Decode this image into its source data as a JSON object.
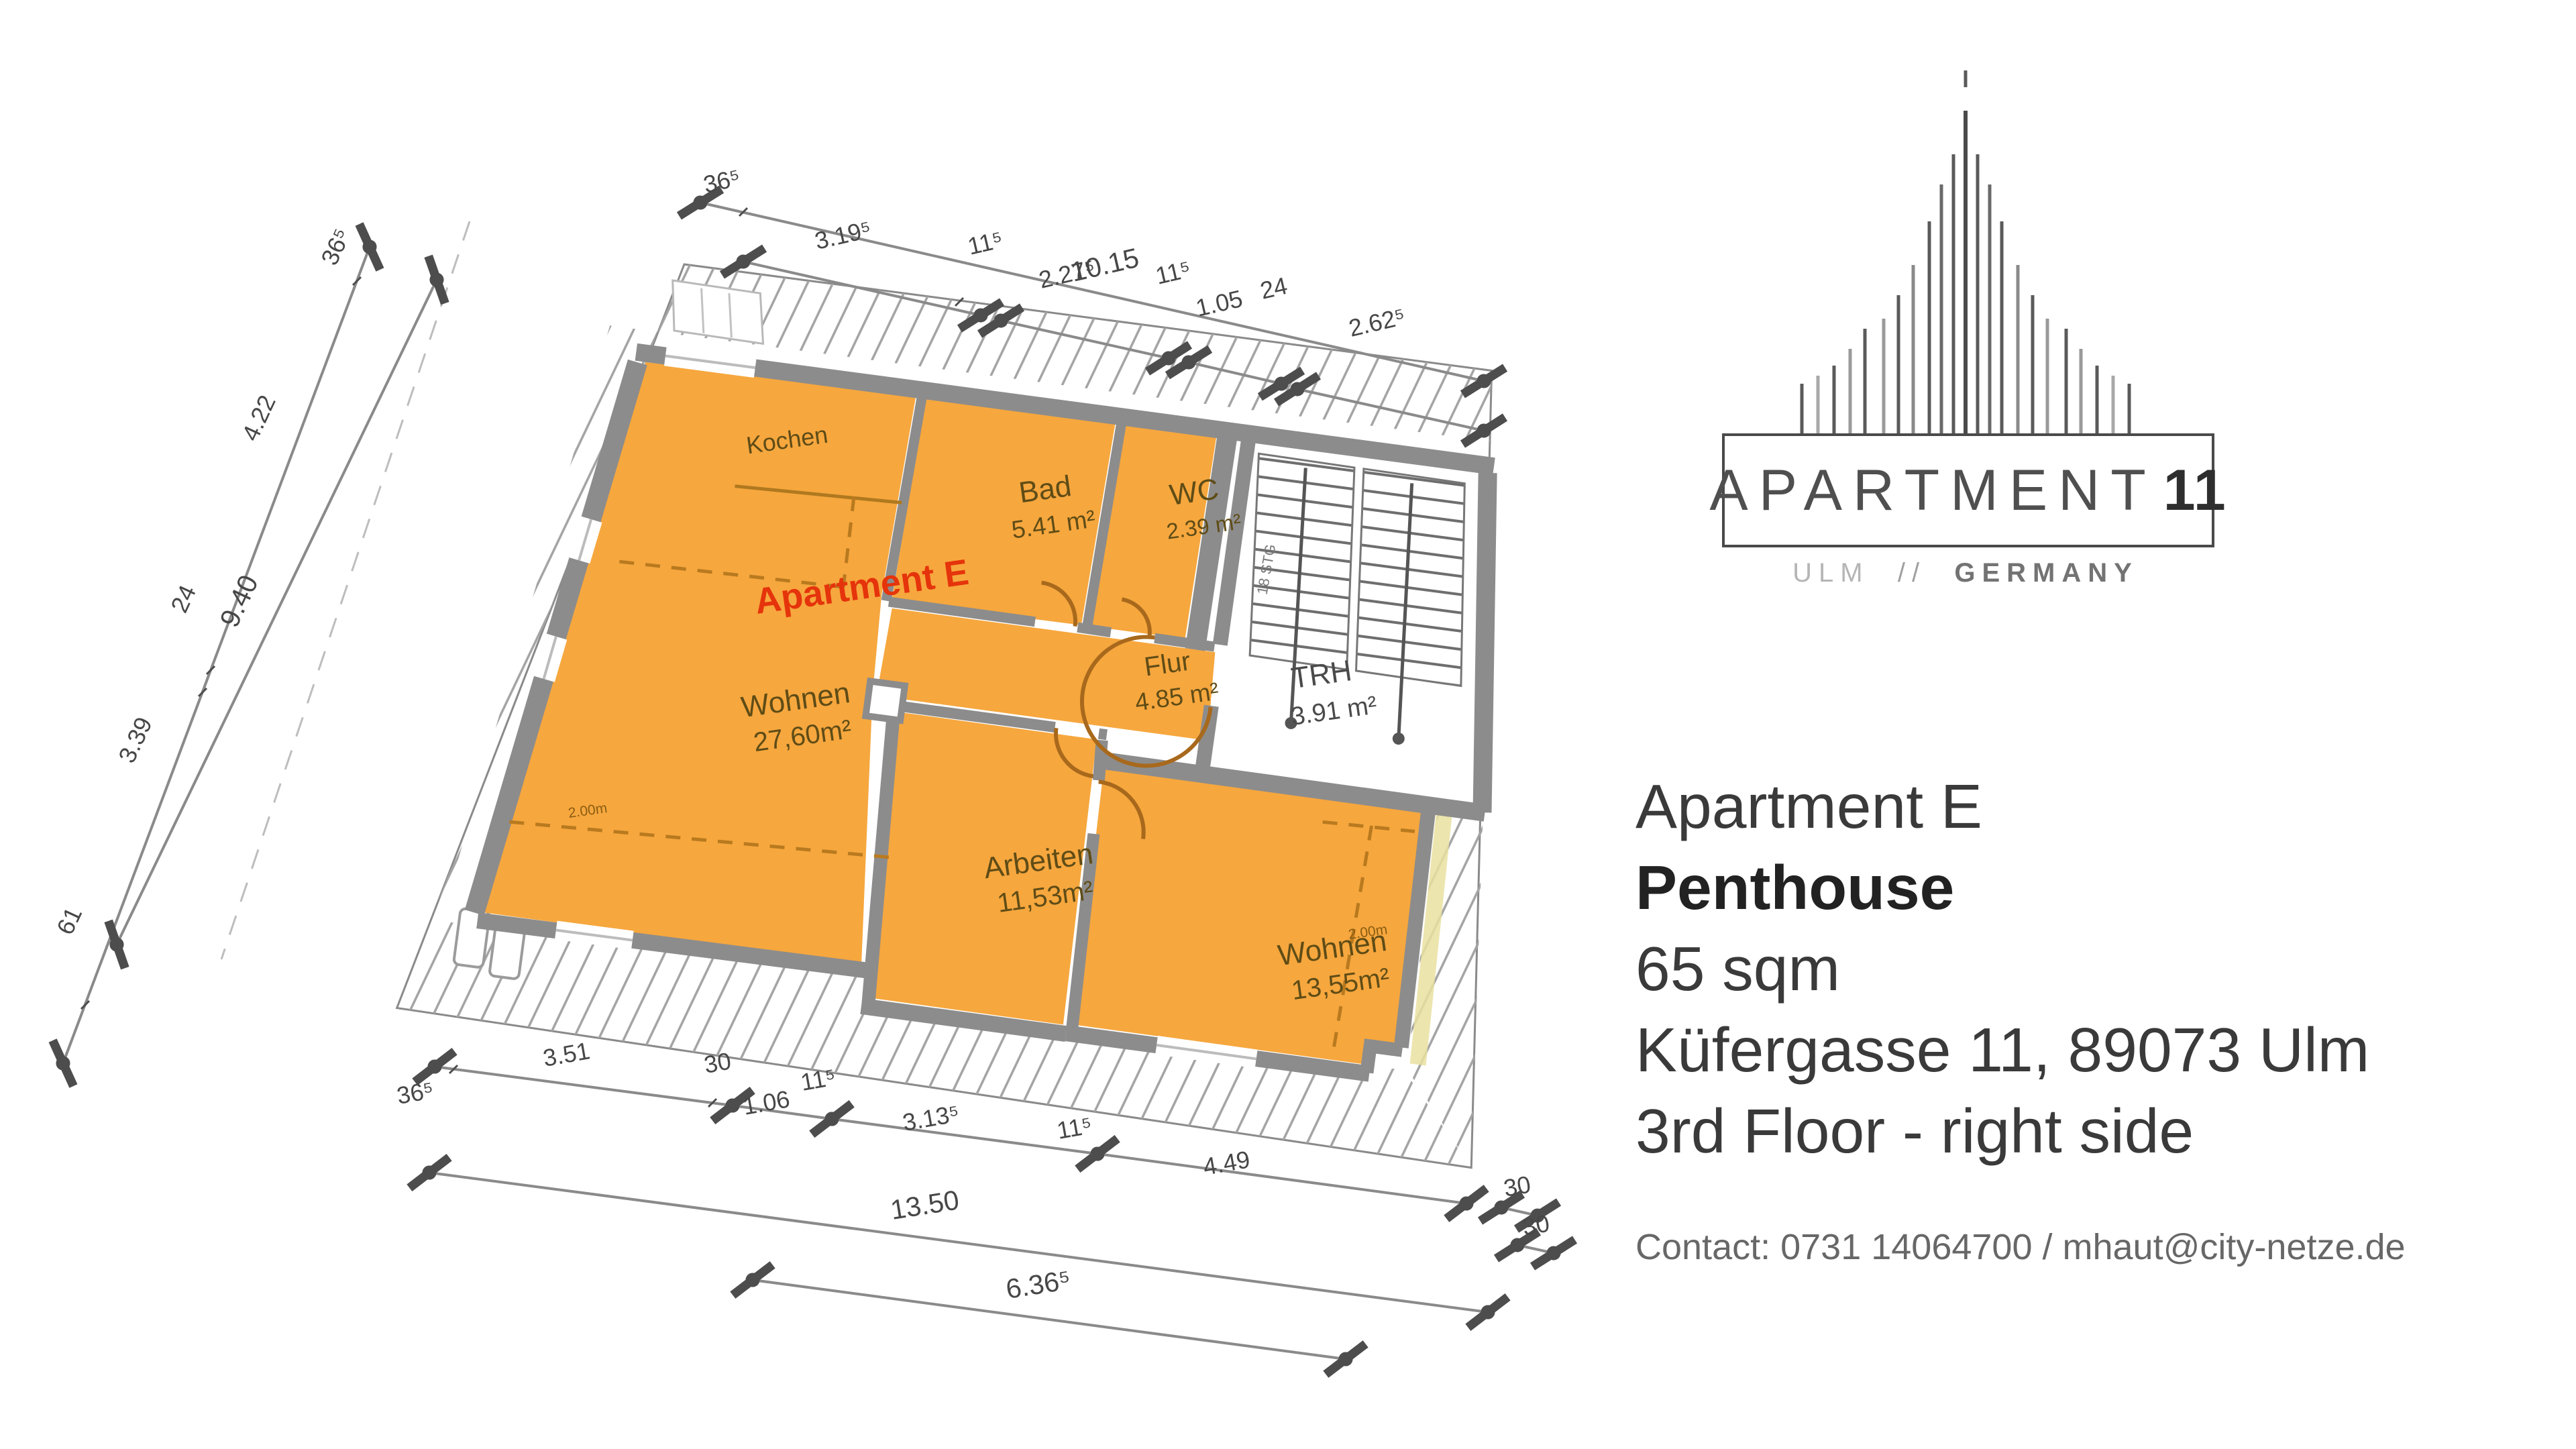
{
  "plan": {
    "apartment_label": "Apartment E",
    "rooms": [
      {
        "name": "Kochen",
        "area": ""
      },
      {
        "name": "Bad",
        "area": "5.41 m²"
      },
      {
        "name": "WC",
        "area": "2.39 m²"
      },
      {
        "name": "Wohnen",
        "area": "27,60m²"
      },
      {
        "name": "Flur",
        "area": "4.85 m²"
      },
      {
        "name": "TRH",
        "area": "3.91 m²"
      },
      {
        "name": "Arbeiten",
        "area": "11,53m²"
      },
      {
        "name": "Wohnen",
        "area": "13,55m²"
      }
    ],
    "stair_label": "18 STG",
    "height_label": "2.00m",
    "dims": {
      "top": [
        "36⁵",
        "10.15",
        "3.19⁵",
        "11⁵",
        "2.27⁵",
        "11⁵",
        "1.05",
        "24",
        "2.62⁵"
      ],
      "left": [
        "36⁵",
        "4.22",
        "24",
        "3.39",
        "61",
        "9.40"
      ],
      "bottom": [
        "36⁵",
        "3.51",
        "30",
        "1.06",
        "11⁵",
        "3.13⁵",
        "11⁵",
        "4.49",
        "13.50",
        "6.36⁵",
        "30",
        "30"
      ]
    },
    "colors": {
      "room_fill": "#f6a73e",
      "wall": "#8c8c8c",
      "accent_red": "#e5340b",
      "door": "#a8691c"
    }
  },
  "branding": {
    "logo_word": "APARTMENT",
    "logo_number": "11",
    "tag_city": "ULM",
    "tag_sep": "//",
    "tag_country": "GERMANY"
  },
  "info": {
    "line1": "Apartment E",
    "line2": "Penthouse",
    "line3": "65 sqm",
    "line4": "Küfergasse 11, 89073 Ulm",
    "line5": "3rd Floor - right side"
  },
  "contact": {
    "text": "Contact: 0731 14064700 / mhaut@city-netze.de"
  }
}
